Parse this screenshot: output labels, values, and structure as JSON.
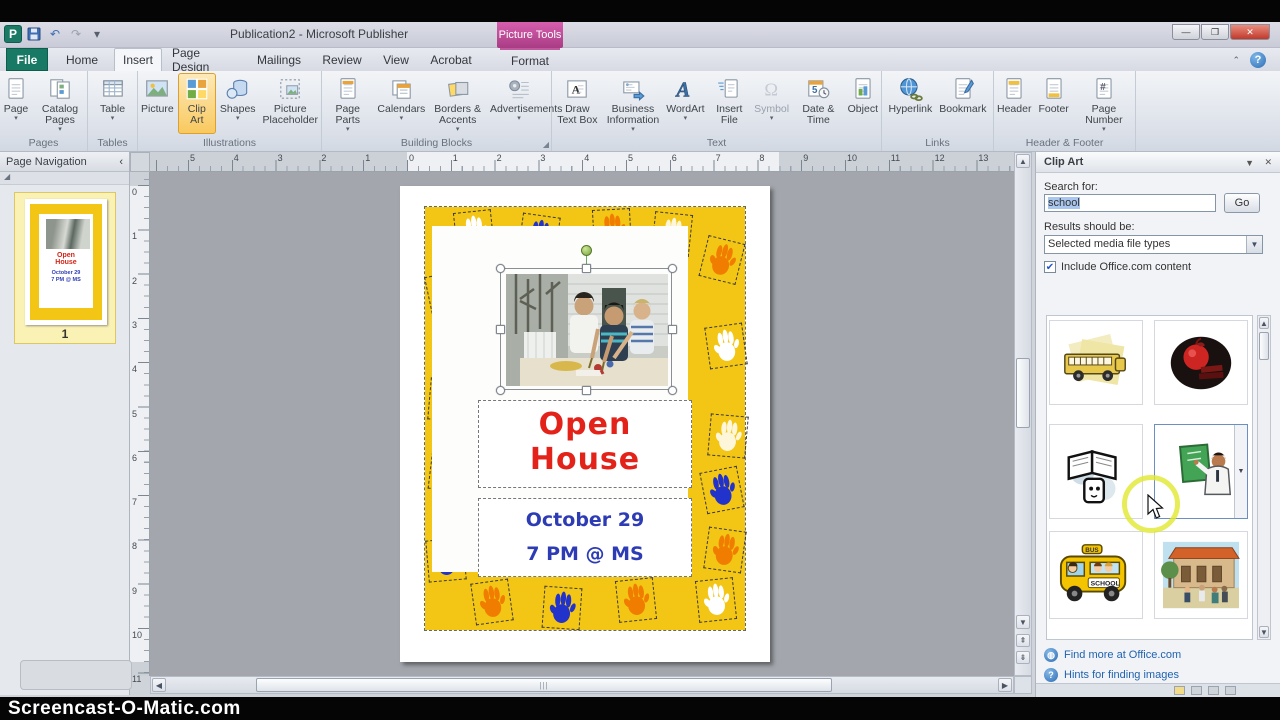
{
  "watermark": {
    "text": "Screencast-O-Matic.com"
  },
  "window": {
    "title": "Publication2 - Microsoft Publisher",
    "contextual_tab_group": "Picture Tools",
    "app_initial": "P",
    "controls": {
      "minimize": "—",
      "maximize": "❐",
      "close": "✕"
    },
    "ribbon_minimize": "⌃",
    "help": "?"
  },
  "qat": [
    {
      "name": "save-icon",
      "glyph": "💾"
    },
    {
      "name": "undo-icon",
      "glyph": "↶"
    },
    {
      "name": "redo-icon",
      "glyph": "↷"
    },
    {
      "name": "qat-customize-icon",
      "glyph": "▾"
    }
  ],
  "tabs": [
    {
      "label": "File",
      "x": 6,
      "w": 42,
      "style": "file"
    },
    {
      "label": "Home",
      "x": 54,
      "w": 56,
      "style": ""
    },
    {
      "label": "Insert",
      "x": 114,
      "w": 48,
      "style": "active"
    },
    {
      "label": "Page Design",
      "x": 166,
      "w": 78,
      "style": ""
    },
    {
      "label": "Mailings",
      "x": 248,
      "w": 62,
      "style": ""
    },
    {
      "label": "Review",
      "x": 314,
      "w": 56,
      "style": ""
    },
    {
      "label": "View",
      "x": 374,
      "w": 44,
      "style": ""
    },
    {
      "label": "Acrobat",
      "x": 422,
      "w": 58,
      "style": ""
    },
    {
      "label": "Format",
      "x": 500,
      "w": 60,
      "style": "ctx"
    }
  ],
  "ribbon": {
    "groups": [
      {
        "name": "Pages",
        "x": 0,
        "w": 88,
        "launcher": false,
        "buttons": [
          {
            "label": "Page",
            "icon": "page",
            "dropdown": true
          },
          {
            "label": "Catalog Pages",
            "icon": "catalog",
            "dropdown": true
          }
        ]
      },
      {
        "name": "Tables",
        "x": 88,
        "w": 50,
        "launcher": false,
        "buttons": [
          {
            "label": "Table",
            "icon": "table",
            "dropdown": true
          }
        ]
      },
      {
        "name": "Illustrations",
        "x": 138,
        "w": 184,
        "launcher": false,
        "buttons": [
          {
            "label": "Picture",
            "icon": "picture"
          },
          {
            "label": "Clip Art",
            "icon": "clipart",
            "active": true
          },
          {
            "label": "Shapes",
            "icon": "shapes",
            "dropdown": true
          },
          {
            "label": "Picture Placeholder",
            "icon": "placeholder"
          }
        ]
      },
      {
        "name": "Building Blocks",
        "x": 322,
        "w": 230,
        "launcher": true,
        "buttons": [
          {
            "label": "Page Parts",
            "icon": "pageparts",
            "dropdown": true
          },
          {
            "label": "Calendars",
            "icon": "calendars",
            "dropdown": true
          },
          {
            "label": "Borders & Accents",
            "icon": "borders",
            "dropdown": true
          },
          {
            "label": "Advertisements",
            "icon": "ads",
            "dropdown": true
          }
        ]
      },
      {
        "name": "Text",
        "x": 552,
        "w": 330,
        "launcher": false,
        "buttons": [
          {
            "label": "Draw Text Box",
            "icon": "textbox"
          },
          {
            "label": "Business Information",
            "icon": "bizinfo",
            "dropdown": true
          },
          {
            "label": "WordArt",
            "icon": "wordart",
            "dropdown": true
          },
          {
            "label": "Insert File",
            "icon": "insertfile"
          },
          {
            "label": "Symbol",
            "icon": "symbol",
            "dropdown": true,
            "disabled": true
          },
          {
            "label": "Date & Time",
            "icon": "datetime"
          },
          {
            "label": "Object",
            "icon": "object"
          }
        ]
      },
      {
        "name": "Links",
        "x": 882,
        "w": 112,
        "launcher": false,
        "buttons": [
          {
            "label": "Hyperlink",
            "icon": "hyperlink"
          },
          {
            "label": "Bookmark",
            "icon": "bookmark"
          }
        ]
      },
      {
        "name": "Header & Footer",
        "x": 994,
        "w": 142,
        "launcher": false,
        "buttons": [
          {
            "label": "Header",
            "icon": "header"
          },
          {
            "label": "Footer",
            "icon": "footer"
          },
          {
            "label": "Page Number",
            "icon": "pagenum",
            "dropdown": true
          }
        ]
      }
    ]
  },
  "nav_pane": {
    "title": "Page Navigation",
    "collapse_glyph": "‹",
    "expand_glyph": "◢",
    "page_number": "1"
  },
  "rulers": {
    "horizontal": [
      "5",
      "4",
      "3",
      "2",
      "1",
      "0",
      "1",
      "2",
      "3",
      "4",
      "5",
      "6",
      "7",
      "8",
      "9",
      "10",
      "11",
      "12",
      "13",
      "14"
    ],
    "h_start": 38,
    "h_step": 43.8,
    "vertical": [
      "0",
      "1",
      "2",
      "3",
      "4",
      "5",
      "6",
      "7",
      "8",
      "9",
      "10",
      "11"
    ],
    "v_start": 13,
    "v_step": 44.3
  },
  "page": {
    "title_line1": "Open",
    "title_line2": "House",
    "date_line1": "October 29",
    "date_line2": "7 PM @ MS",
    "title_color": "#e3231a",
    "date_color": "#2d3cb5",
    "border_color": "#f3c514",
    "handprints": [
      {
        "x": 30,
        "y": 4,
        "color": "#ffffff",
        "rot": -6
      },
      {
        "x": 95,
        "y": 8,
        "color": "#2233cc",
        "rot": 8
      },
      {
        "x": 168,
        "y": 2,
        "color": "#f07d00",
        "rot": -3
      },
      {
        "x": 228,
        "y": 6,
        "color": "#fdf6d8",
        "rot": 6
      },
      {
        "x": 278,
        "y": 32,
        "color": "#f07d00",
        "rot": 14
      },
      {
        "x": 282,
        "y": 118,
        "color": "#ffffff",
        "rot": -8
      },
      {
        "x": 284,
        "y": 208,
        "color": "#fdf6d8",
        "rot": 5
      },
      {
        "x": 278,
        "y": 262,
        "color": "#2233cc",
        "rot": -11
      },
      {
        "x": 281,
        "y": 322,
        "color": "#f07d00",
        "rot": 8
      },
      {
        "x": 272,
        "y": 372,
        "color": "#ffffff",
        "rot": -6
      },
      {
        "x": 3,
        "y": 66,
        "color": "#2233cc",
        "rot": -12
      },
      {
        "x": 4,
        "y": 172,
        "color": "#ffffff",
        "rot": 5
      },
      {
        "x": 5,
        "y": 242,
        "color": "#f07d00",
        "rot": 7
      },
      {
        "x": 2,
        "y": 332,
        "color": "#2233cc",
        "rot": -5
      },
      {
        "x": 48,
        "y": 374,
        "color": "#f07d00",
        "rot": -8
      },
      {
        "x": 118,
        "y": 380,
        "color": "#2233cc",
        "rot": 4
      },
      {
        "x": 192,
        "y": 372,
        "color": "#f07d00",
        "rot": -6
      }
    ]
  },
  "clipart_pane": {
    "title": "Clip Art",
    "menu_glyph": "▼",
    "close_glyph": "✕",
    "search_label": "Search for:",
    "search_value": "school",
    "go_label": "Go",
    "results_label": "Results should be:",
    "media_filter": "Selected media file types",
    "checkbox_checked": "✔",
    "include_office": "Include Office.com content",
    "results": [
      {
        "name": "school-bus-side-clipart",
        "art": "bus_side",
        "col": 0,
        "row": 0
      },
      {
        "name": "apple-books-badge-clipart",
        "art": "apple_badge",
        "col": 1,
        "row": 0
      },
      {
        "name": "book-reader-clipart",
        "art": "book_reader",
        "col": 0,
        "row": 1
      },
      {
        "name": "teacher-chalkboard-clipart",
        "art": "teacher_board",
        "col": 1,
        "row": 1,
        "selected": true
      },
      {
        "name": "cartoon-school-bus-clipart",
        "art": "bus_cartoon",
        "col": 0,
        "row": 2
      },
      {
        "name": "school-building-clipart",
        "art": "school_building",
        "col": 1,
        "row": 2
      }
    ],
    "links": [
      {
        "label": "Find more at Office.com",
        "icon": "globe"
      },
      {
        "label": "Hints for finding images",
        "icon": "help"
      }
    ]
  }
}
